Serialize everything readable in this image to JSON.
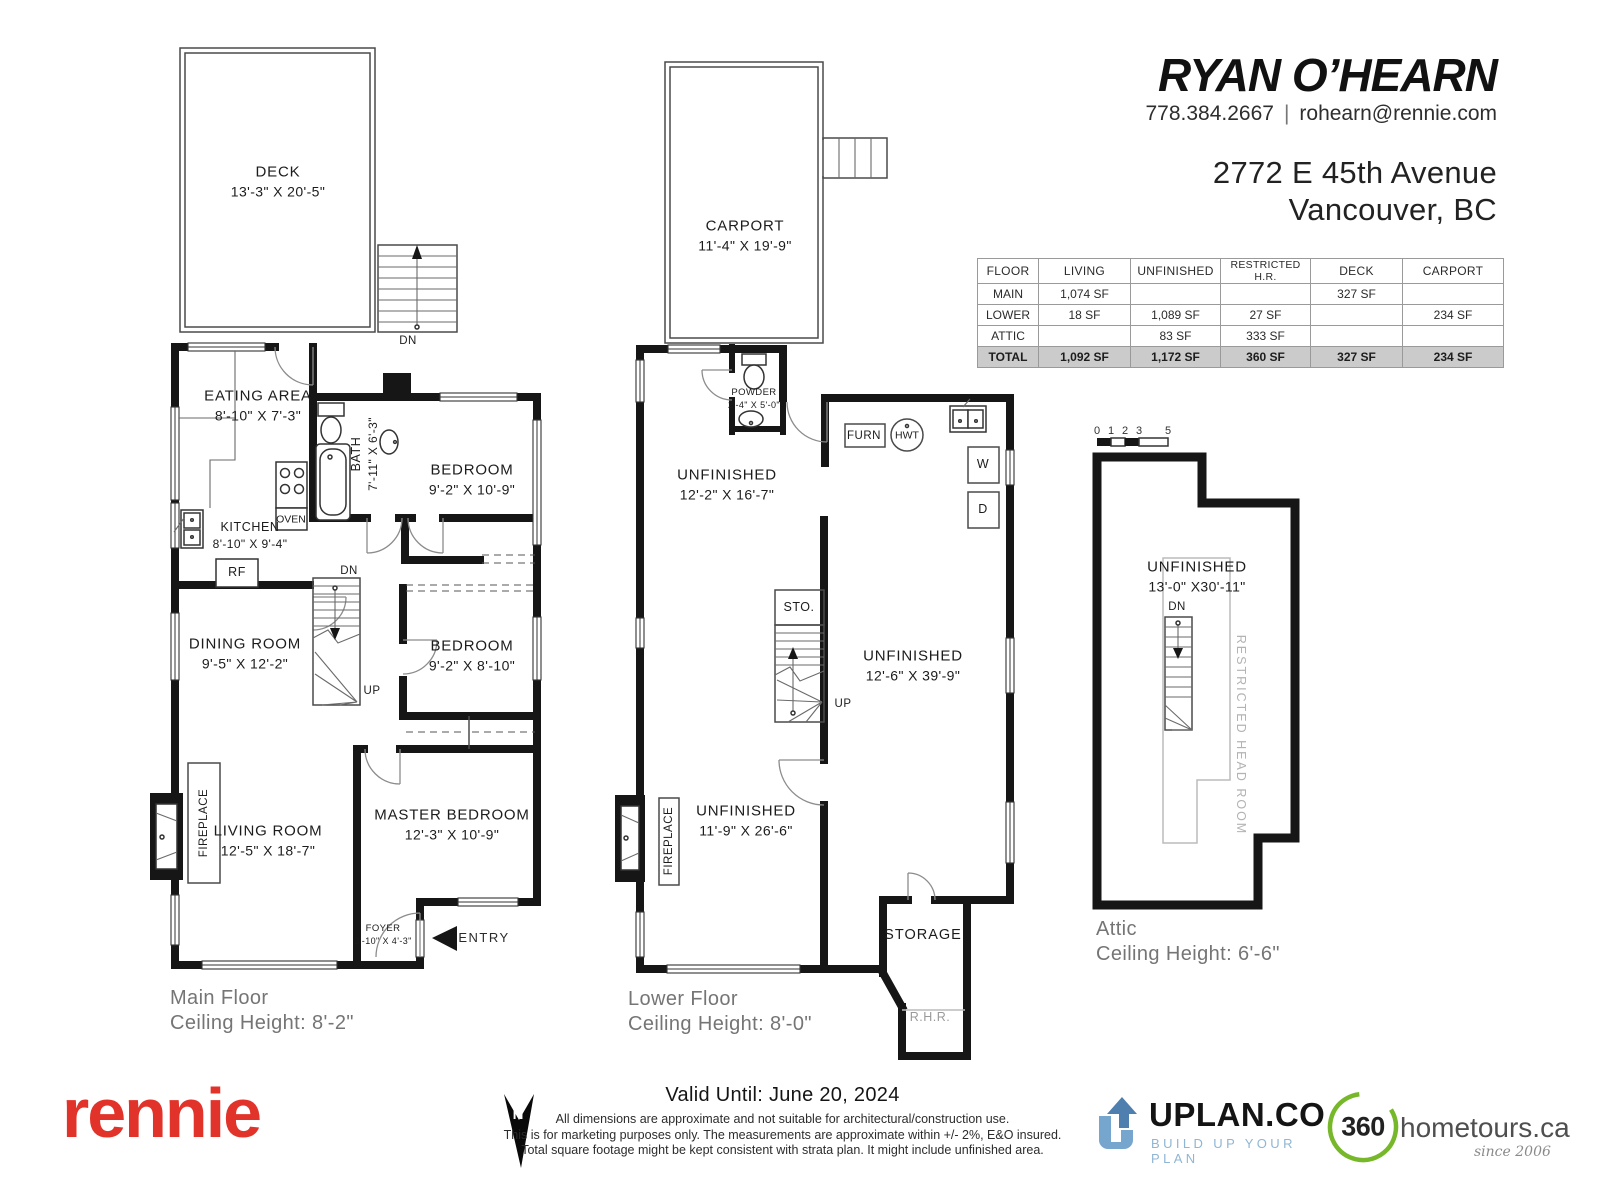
{
  "header": {
    "agent_name": "RYAN O’HEARN",
    "phone": "778.384.2667",
    "divider": "|",
    "email": "rohearn@rennie.com",
    "address_line1": "2772 E 45th Avenue",
    "address_line2": "Vancouver, BC"
  },
  "area_table": {
    "headers": [
      "FLOOR",
      "LIVING",
      "UNFINISHED",
      "RESTRICTED H.R.",
      "DECK",
      "CARPORT"
    ],
    "rows": [
      [
        "MAIN",
        "1,074 SF",
        "",
        "",
        "327 SF",
        ""
      ],
      [
        "LOWER",
        "18 SF",
        "1,089 SF",
        "27 SF",
        "",
        "234 SF"
      ],
      [
        "ATTIC",
        "",
        "83 SF",
        "333 SF",
        "",
        ""
      ],
      [
        "TOTAL",
        "1,092 SF",
        "1,172 SF",
        "360 SF",
        "327 SF",
        "234 SF"
      ]
    ]
  },
  "main_floor": {
    "deck": {
      "name": "DECK",
      "dims": "13'-3\" X 20'-5\""
    },
    "deck_dn_label": "DN",
    "eating_area": {
      "name": "EATING AREA",
      "dims": "8'-10\" X  7'-3\""
    },
    "kitchen": {
      "name": "KITCHEN",
      "dims": "8'-10\" X  9'-4\""
    },
    "bath": {
      "name": "BATH",
      "dims": "7'-11\" X 6'-3\""
    },
    "bedroom1": {
      "name": "BEDROOM",
      "dims": "9'-2\" X 10'-9\""
    },
    "dining_room": {
      "name": "DINING ROOM",
      "dims": "9'-5\"  X 12'-2\""
    },
    "bedroom2": {
      "name": "BEDROOM",
      "dims": "9'-2\"  X 8'-10\""
    },
    "living_room": {
      "name": "LIVING ROOM",
      "dims": "12'-5\" X 18'-7\""
    },
    "master_bedroom": {
      "name": "MASTER BEDROOM",
      "dims": "12'-3\" X 10'-9\""
    },
    "foyer": {
      "name": "FOYER",
      "dims": "3'-10\" X  4'-3\""
    },
    "oven_label": "OVEN",
    "rf_label": "RF",
    "fireplace_label": "FIREPLACE",
    "dn_label": "DN",
    "up_label": "UP",
    "entry_label": "ENTRY",
    "caption_title": "Main Floor",
    "caption_sub": "Ceiling Height: 8'-2\""
  },
  "lower_floor": {
    "carport": {
      "name": "CARPORT",
      "dims": "11'-4\" X 19'-9\""
    },
    "powder": {
      "name": "POWDER",
      "dims": "2'-4\" X 5'-0\""
    },
    "unfinished_left": {
      "name": "UNFINISHED",
      "dims": "12'-2\" X 16'-7\""
    },
    "unfinished_right": {
      "name": "UNFINISHED",
      "dims": "12'-6\" X 39'-9\""
    },
    "unfinished_bottom": {
      "name": "UNFINISHED",
      "dims": "11'-9\" X 26'-6\""
    },
    "sto_label": "STO.",
    "storage_label": "STORAGE",
    "rhr_label": "R.H.R.",
    "furn_label": "FURN",
    "hwt_label": "HWT",
    "washer_label": "W",
    "dryer_label": "D",
    "fireplace_label": "FIREPLACE",
    "up_label": "UP",
    "caption_title": "Lower Floor",
    "caption_sub": "Ceiling Height: 8'-0\""
  },
  "attic": {
    "scale_labels": [
      "0",
      "1",
      "2",
      "3",
      "5"
    ],
    "unfinished": {
      "name": "UNFINISHED",
      "dims": "13'-0\" X30'-11\""
    },
    "dn_label": "DN",
    "restricted_label": "RESTRICTED HEAD ROOM",
    "caption_title": "Attic",
    "caption_sub": "Ceiling Height: 6'-6\""
  },
  "footer": {
    "brand": "rennie",
    "brand_color": "#e2332a",
    "north_label": "N",
    "valid_until": "Valid Until: June 20, 2024",
    "disclaimer_lines": [
      "All dimensions are approximate and not suitable for architectural/construction use.",
      "This is for marketing purposes only. The measurements are approximate within +/- 2%, E&O insured.",
      "Total square footage might be kept consistent with strata plan. It might include unfinished area."
    ],
    "uplan": {
      "name": "UPLAN.CO",
      "tagline": "BUILD UP YOUR PLAN",
      "blue": "#4f7fae",
      "light_blue": "#76a5ce"
    },
    "hometours": {
      "circle_text": "360",
      "name": "hometours.ca",
      "since": "since 2006",
      "green": "#76b82a"
    }
  }
}
